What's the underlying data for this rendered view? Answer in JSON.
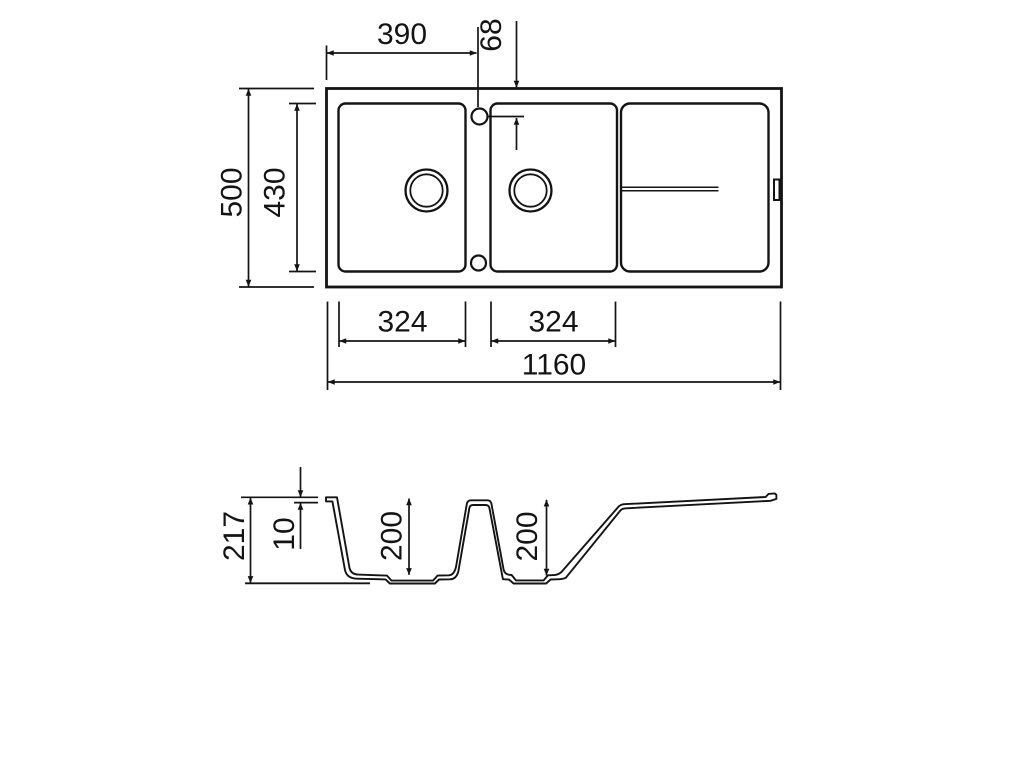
{
  "page": {
    "background": "#ffffff",
    "line_color": "#141414"
  },
  "plan_view": {
    "dims": {
      "taphole_offset_x": "390",
      "taphole_offset_y": "68",
      "overall_depth": "500",
      "basin_depth": "430",
      "bowl1_width": "324",
      "bowl2_width": "324",
      "overall_width": "1160"
    }
  },
  "section_view": {
    "dims": {
      "overall_height": "217",
      "rim_thickness": "10",
      "bowl1_depth": "200",
      "bowl2_depth": "200"
    }
  }
}
